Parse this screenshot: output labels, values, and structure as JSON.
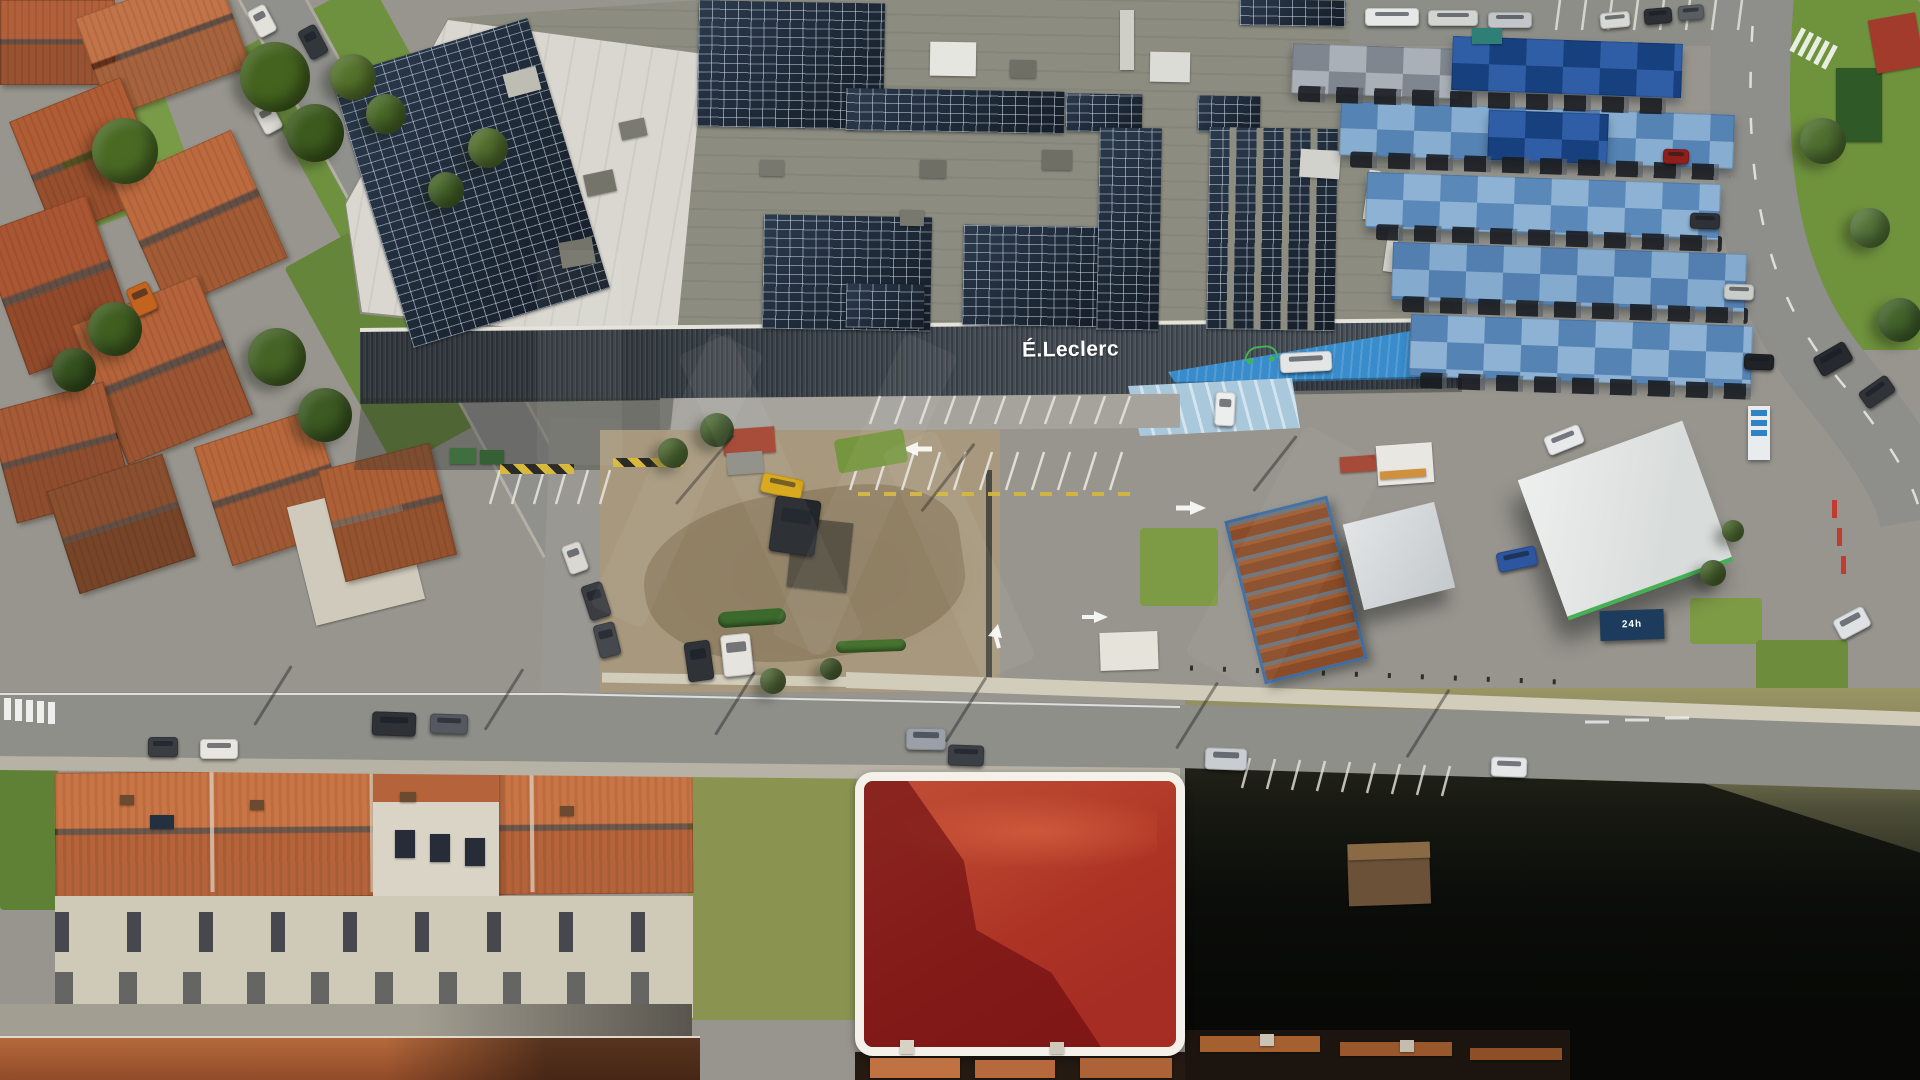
{
  "scene": {
    "type": "aerial-drone-photograph",
    "description": "Aerial view of an E.Leclerc supermarket with rooftop solar panels, blue shaded parking canopies, a fuel station, surrounding residential streets with terracotta roofs, and a vacant land plot highlighted in red with a white rounded outline"
  },
  "building": {
    "sign_text": "É.Leclerc"
  },
  "labels": {
    "container_text": "24h"
  },
  "colors": {
    "asphalt": "#97958e",
    "road": "#8f8f8a",
    "roadside": "#b7b2a6",
    "roof_gray": "#8c8c80",
    "roof_white": "#d9d7cf",
    "panel": "#1b2531",
    "facade": "#49525a",
    "parapet": "#e5e2da",
    "entrance_blue": "#2f83c4",
    "pave_blue": "#a9c8dc",
    "canopy_navy": "#16407e",
    "canopy_light": "#8db2d3",
    "terracotta": "#b5633a",
    "terracotta_light": "#c97545",
    "terracotta_dark": "#8f4a28",
    "facade_house": "#cfc9b8",
    "grass": "#6e9140",
    "dirt": "#a8997e",
    "dirt_dark": "#8d7c60",
    "wall_pale": "#d2ccba",
    "plot_border": "#f4f1ea",
    "plot_red": "rgba(175,12,22,0.5)",
    "plot_shadow": "rgba(22,4,8,0.58)",
    "plot_dirt_light": "#d08a52",
    "plot_dirt": "#aa5c34",
    "dark_land": "#15170f",
    "rust": "#8a4c28",
    "container_navy": "#1d3b5c",
    "logo_green": "#43b154",
    "hazard_yellow": "#d8b93c"
  },
  "ground_sprites": [
    [
      "grass",
      285,
      0,
      150,
      235,
      -29,
      "#6e9140"
    ],
    [
      "grass",
      330,
      215,
      160,
      230,
      -29,
      "#64853a"
    ],
    [
      "grass",
      60,
      84,
      120,
      130,
      -20,
      "#799a47"
    ],
    [
      "grass",
      1790,
      0,
      130,
      350,
      0,
      "#6f923d"
    ],
    [
      "grass",
      0,
      735,
      58,
      175,
      0,
      "#5f8136"
    ],
    [
      "grass",
      688,
      758,
      168,
      262,
      0,
      "#8a9450"
    ],
    [
      "grass",
      1140,
      528,
      78,
      78,
      0,
      "#7d9b45"
    ],
    [
      "grass",
      1690,
      598,
      72,
      46,
      0,
      "#7d9b45"
    ],
    [
      "grass",
      1756,
      640,
      92,
      52,
      0,
      "#6d8c3c"
    ],
    [
      "roof",
      0,
      0,
      115,
      85,
      0,
      "#b2603a"
    ],
    [
      "roof",
      88,
      -10,
      150,
      105,
      -20,
      "#c27347"
    ],
    [
      "roof",
      28,
      95,
      120,
      125,
      -22,
      "#b05c34"
    ],
    [
      "roof",
      135,
      150,
      130,
      140,
      -24,
      "#bc6a3e"
    ],
    [
      "roof",
      0,
      210,
      115,
      150,
      -20,
      "#aa5632"
    ],
    [
      "roof",
      95,
      295,
      135,
      150,
      -22,
      "#b4633a"
    ],
    [
      "roof",
      0,
      395,
      120,
      115,
      -15,
      "#a65a36"
    ],
    [
      "roof",
      210,
      425,
      125,
      125,
      -18,
      "#b9683c"
    ],
    [
      "box",
      300,
      492,
      112,
      122,
      -14,
      "#cfcabc"
    ],
    [
      "roof",
      330,
      455,
      115,
      115,
      -14,
      "#ad5f36"
    ],
    [
      "roof",
      60,
      470,
      122,
      108,
      -18,
      "#8a4f2e"
    ],
    [
      "box",
      1836,
      68,
      46,
      74,
      0,
      "#2f5a28"
    ],
    [
      "box",
      1872,
      16,
      48,
      54,
      -10,
      "#a23b2c"
    ]
  ],
  "sprites": [
    [
      "solar",
      368,
      42,
      205,
      282,
      -17
    ],
    [
      "solar",
      698,
      2,
      186,
      126,
      1
    ],
    [
      "solar",
      846,
      90,
      218,
      42,
      1
    ],
    [
      "solar",
      1066,
      94,
      76,
      38,
      1
    ],
    [
      "solar",
      1198,
      96,
      62,
      36,
      1
    ],
    [
      "solar",
      763,
      216,
      168,
      114,
      1
    ],
    [
      "solar",
      846,
      284,
      78,
      44,
      1
    ],
    [
      "solar",
      963,
      226,
      140,
      100,
      1
    ],
    [
      "solar",
      1098,
      128,
      62,
      202,
      1
    ],
    [
      "solarcols",
      1208,
      128,
      128,
      202,
      1
    ],
    [
      "solar",
      1240,
      0,
      105,
      26,
      1
    ],
    [
      "box",
      585,
      172,
      30,
      22,
      -12,
      "#74746a"
    ],
    [
      "box",
      620,
      120,
      26,
      18,
      -12,
      "#7a7a70"
    ],
    [
      "box",
      505,
      70,
      34,
      24,
      -15,
      "#bdbdb3"
    ],
    [
      "box",
      560,
      240,
      34,
      26,
      -10,
      "#74746a"
    ],
    [
      "box",
      920,
      160,
      26,
      18,
      1,
      "#6f6f65"
    ],
    [
      "box",
      1010,
      60,
      26,
      18,
      1,
      "#6f6f65"
    ],
    [
      "box",
      760,
      160,
      24,
      16,
      1,
      "#78786e"
    ],
    [
      "box",
      930,
      42,
      46,
      34,
      1,
      "#e6e6e0"
    ],
    [
      "box",
      1150,
      52,
      40,
      30,
      1,
      "#dcdcd6"
    ],
    [
      "box",
      1300,
      150,
      40,
      28,
      4,
      "#d2d2cc"
    ],
    [
      "box",
      1042,
      150,
      30,
      20,
      1,
      "#6f6f65"
    ],
    [
      "box",
      900,
      210,
      24,
      16,
      1,
      "#78786e"
    ],
    [
      "box",
      1120,
      10,
      14,
      60,
      0,
      "#cfcfc8"
    ],
    [
      "box",
      1366,
      170,
      11,
      50,
      8,
      "#d8d8d0"
    ],
    [
      "box",
      1386,
      224,
      11,
      48,
      8,
      "#d0d0c8"
    ],
    [
      "canopy",
      1292,
      46,
      168,
      50,
      2,
      "#aab0b8",
      "#7f868f"
    ],
    [
      "canopy",
      1452,
      40,
      230,
      54,
      2,
      "#16407e",
      "#2f5ea6"
    ],
    [
      "canopy",
      1340,
      108,
      394,
      54,
      2,
      "#87add0",
      "#5583b4"
    ],
    [
      "canopy",
      1488,
      112,
      120,
      50,
      2,
      "#16407e",
      "#2f5ea6"
    ],
    [
      "canopy",
      1366,
      178,
      354,
      56,
      2,
      "#8db2d3",
      "#5a88b8"
    ],
    [
      "canopy",
      1392,
      248,
      354,
      58,
      2,
      "#84abce",
      "#537fb0"
    ],
    [
      "canopy",
      1410,
      320,
      342,
      62,
      2,
      "#8db2d3",
      "#5583b4"
    ],
    [
      "carstrip",
      1298,
      92,
      368,
      16,
      2
    ],
    [
      "carstrip",
      1350,
      158,
      380,
      16,
      2
    ],
    [
      "carstrip",
      1376,
      230,
      346,
      16,
      2
    ],
    [
      "carstrip",
      1402,
      302,
      346,
      16,
      2
    ],
    [
      "carstrip",
      1420,
      378,
      332,
      16,
      2
    ],
    [
      "hedge",
      718,
      610,
      68,
      16,
      -4,
      "#3c6a2c"
    ],
    [
      "hedge",
      836,
      640,
      70,
      12,
      -2,
      "#46742f"
    ],
    [
      "grass",
      836,
      434,
      70,
      34,
      -10,
      "#75953f"
    ],
    [
      "hazard",
      500,
      464,
      74,
      10,
      0
    ],
    [
      "hazard",
      613,
      458,
      70,
      9,
      0
    ],
    [
      "box",
      723,
      428,
      52,
      26,
      -4,
      "#a34430"
    ],
    [
      "box",
      727,
      452,
      36,
      22,
      -4,
      "#8e8e86"
    ],
    [
      "box",
      1100,
      632,
      58,
      38,
      -2,
      "#e6e3da"
    ],
    [
      "box",
      1377,
      444,
      56,
      40,
      -4,
      "#e9e7e2"
    ],
    [
      "box",
      1380,
      470,
      46,
      8,
      -4,
      "#d0903c"
    ],
    [
      "box",
      1340,
      456,
      36,
      16,
      -4,
      "#a34430"
    ],
    [
      "box",
      1348,
      843,
      82,
      62,
      -2,
      "#6b5137"
    ],
    [
      "box",
      1348,
      843,
      82,
      16,
      -2,
      "#8a6a45"
    ],
    [
      "box",
      790,
      520,
      60,
      70,
      6,
      "rgba(20,22,20,0.5)"
    ],
    [
      "car",
      148,
      737,
      30,
      20,
      0,
      "#3a3d42"
    ],
    [
      "car",
      200,
      739,
      38,
      20,
      0,
      "#e8e6e0"
    ],
    [
      "car",
      372,
      712,
      44,
      24,
      2,
      "#2e3136"
    ],
    [
      "car",
      430,
      714,
      38,
      20,
      2,
      "#55585e"
    ],
    [
      "car",
      906,
      728,
      40,
      22,
      1,
      "#9aa0a6"
    ],
    [
      "car",
      948,
      745,
      36,
      21,
      2,
      "#3c4046"
    ],
    [
      "car",
      1205,
      748,
      42,
      22,
      2,
      "#c9cdd2"
    ],
    [
      "car",
      1491,
      757,
      36,
      20,
      2,
      "#e4e6e8"
    ],
    [
      "car",
      1835,
      612,
      34,
      22,
      -28,
      "#dfe2e4"
    ],
    [
      "car",
      1815,
      348,
      36,
      22,
      -30,
      "#26292e"
    ],
    [
      "car",
      1860,
      382,
      34,
      20,
      -35,
      "#303338"
    ],
    [
      "car",
      686,
      641,
      26,
      40,
      -8,
      "#2f3237"
    ],
    [
      "car",
      722,
      634,
      30,
      42,
      -6,
      "#e6e4de"
    ],
    [
      "car",
      585,
      583,
      22,
      36,
      -18,
      "#3a3d41"
    ],
    [
      "car",
      596,
      623,
      22,
      34,
      -14,
      "#45484d"
    ],
    [
      "car",
      565,
      543,
      20,
      30,
      -20,
      "#d9d8d2"
    ],
    [
      "car",
      252,
      6,
      20,
      30,
      -28,
      "#e2e1db"
    ],
    [
      "car",
      303,
      26,
      20,
      32,
      -28,
      "#33373c"
    ],
    [
      "car",
      258,
      103,
      20,
      30,
      -28,
      "#dddcd6"
    ],
    [
      "car",
      130,
      284,
      24,
      30,
      -24,
      "#c2641f"
    ],
    [
      "car",
      1497,
      549,
      40,
      20,
      -12,
      "#2d55a0"
    ],
    [
      "car",
      1545,
      430,
      38,
      20,
      -22,
      "#e8e9ea"
    ],
    [
      "car",
      761,
      476,
      42,
      20,
      12,
      "#d7a514"
    ],
    [
      "car",
      772,
      498,
      46,
      56,
      8,
      "#23262b"
    ],
    [
      "car",
      1215,
      392,
      20,
      34,
      3,
      "#eceeee"
    ],
    [
      "car",
      1280,
      352,
      52,
      20,
      -3,
      "#e4e6e6"
    ],
    [
      "car",
      1365,
      8,
      54,
      18,
      0,
      "#e6e8e8"
    ],
    [
      "car",
      1428,
      10,
      50,
      16,
      0,
      "#d2d4d2"
    ],
    [
      "car",
      1488,
      12,
      44,
      16,
      0,
      "#c2c6c8"
    ],
    [
      "box",
      1472,
      28,
      30,
      16,
      0,
      "#2e8076"
    ],
    [
      "car",
      1600,
      12,
      30,
      16,
      -5,
      "#d8d9d4"
    ],
    [
      "car",
      1644,
      8,
      28,
      16,
      -5,
      "#2c2f34"
    ],
    [
      "car",
      1678,
      5,
      26,
      15,
      -5,
      "#5a5e63"
    ],
    [
      "car",
      1690,
      213,
      30,
      16,
      2,
      "#2e3136"
    ],
    [
      "car",
      1724,
      284,
      30,
      16,
      2,
      "#caccc9"
    ],
    [
      "car",
      1744,
      354,
      30,
      16,
      2,
      "#1f2226"
    ],
    [
      "car",
      1663,
      149,
      26,
      15,
      2,
      "#8f1f1a"
    ],
    [
      "tree",
      240,
      42,
      70,
      70,
      0,
      "#44631f"
    ],
    [
      "tree",
      286,
      104,
      58,
      58,
      0,
      "#3c5a1e"
    ],
    [
      "tree",
      92,
      118,
      66,
      66,
      0,
      "#4a6a24"
    ],
    [
      "tree",
      330,
      54,
      46,
      46,
      0,
      "#55732c"
    ],
    [
      "tree",
      366,
      94,
      40,
      40,
      0,
      "#4a6a28"
    ],
    [
      "tree",
      88,
      302,
      54,
      54,
      0,
      "#3f5e20"
    ],
    [
      "tree",
      52,
      348,
      44,
      44,
      0,
      "#35511d"
    ],
    [
      "tree",
      248,
      328,
      58,
      58,
      0,
      "#446325"
    ],
    [
      "tree",
      298,
      388,
      54,
      54,
      0,
      "#3c5a22"
    ],
    [
      "tree",
      468,
      128,
      40,
      40,
      0,
      "#526f2d"
    ],
    [
      "tree",
      428,
      172,
      36,
      36,
      0,
      "#47662a"
    ],
    [
      "tree",
      700,
      413,
      34,
      34,
      0,
      "#3f5c26"
    ],
    [
      "tree",
      658,
      438,
      30,
      30,
      0,
      "#456326"
    ],
    [
      "tree",
      1800,
      118,
      46,
      46,
      0,
      "#4f7030"
    ],
    [
      "tree",
      1850,
      208,
      40,
      40,
      0,
      "#55763a"
    ],
    [
      "tree",
      1878,
      298,
      44,
      44,
      0,
      "#43642c"
    ],
    [
      "tree",
      760,
      668,
      26,
      26,
      0,
      "#57703a"
    ],
    [
      "tree",
      820,
      658,
      22,
      22,
      0,
      "#4c6532"
    ],
    [
      "tree",
      1700,
      560,
      26,
      26,
      0,
      "#4c6b2e"
    ],
    [
      "tree",
      1722,
      520,
      22,
      22,
      0,
      "#557434"
    ],
    [
      "box",
      870,
      1058,
      90,
      20,
      0,
      "#c07242"
    ],
    [
      "box",
      975,
      1060,
      80,
      18,
      0,
      "#b5693c"
    ],
    [
      "box",
      1080,
      1058,
      92,
      20,
      0,
      "#ad6238"
    ],
    [
      "box",
      1200,
      1036,
      120,
      16,
      0,
      "#a5602f"
    ],
    [
      "box",
      1340,
      1042,
      112,
      14,
      0,
      "#99572c"
    ],
    [
      "box",
      1470,
      1048,
      92,
      12,
      0,
      "#8d4f28"
    ],
    [
      "box",
      900,
      1040,
      14,
      14,
      0,
      "#d8d2c4"
    ],
    [
      "box",
      1050,
      1042,
      14,
      12,
      0,
      "#cfc9bb"
    ],
    [
      "box",
      1260,
      1034,
      14,
      12,
      0,
      "#c9c3b5"
    ],
    [
      "box",
      1400,
      1040,
      14,
      12,
      0,
      "#c3bdaf"
    ],
    [
      "box",
      120,
      795,
      14,
      10,
      0,
      "#6b4a30"
    ],
    [
      "box",
      250,
      800,
      14,
      10,
      0,
      "#6b4a30"
    ],
    [
      "box",
      400,
      792,
      16,
      10,
      0,
      "#6b4a30"
    ],
    [
      "box",
      560,
      806,
      14,
      10,
      0,
      "#6b4a30"
    ],
    [
      "box",
      150,
      815,
      24,
      14,
      0,
      "#223040"
    ],
    [
      "box",
      395,
      830,
      20,
      28,
      0,
      "#262c38"
    ],
    [
      "box",
      430,
      834,
      20,
      28,
      0,
      "#262c38"
    ],
    [
      "box",
      465,
      838,
      20,
      28,
      0,
      "#262c38"
    ],
    [
      "box",
      450,
      448,
      26,
      16,
      0,
      "#3f6f3f"
    ],
    [
      "box",
      480,
      450,
      24,
      14,
      0,
      "#356033"
    ],
    [
      "shadowline",
      238,
      694,
      70,
      3,
      -58
    ],
    [
      "shadowline",
      468,
      698,
      72,
      3,
      -58
    ],
    [
      "shadowline",
      698,
      702,
      74,
      3,
      -58
    ],
    [
      "shadowline",
      928,
      708,
      76,
      3,
      -58
    ],
    [
      "shadowline",
      1158,
      714,
      78,
      3,
      -58
    ],
    [
      "shadowline",
      1388,
      722,
      80,
      3,
      -58
    ],
    [
      "shadowline",
      660,
      468,
      90,
      3,
      -50
    ],
    [
      "shadowline",
      905,
      476,
      86,
      3,
      -52
    ],
    [
      "shadowline",
      1240,
      462,
      70,
      3,
      -52
    ]
  ]
}
